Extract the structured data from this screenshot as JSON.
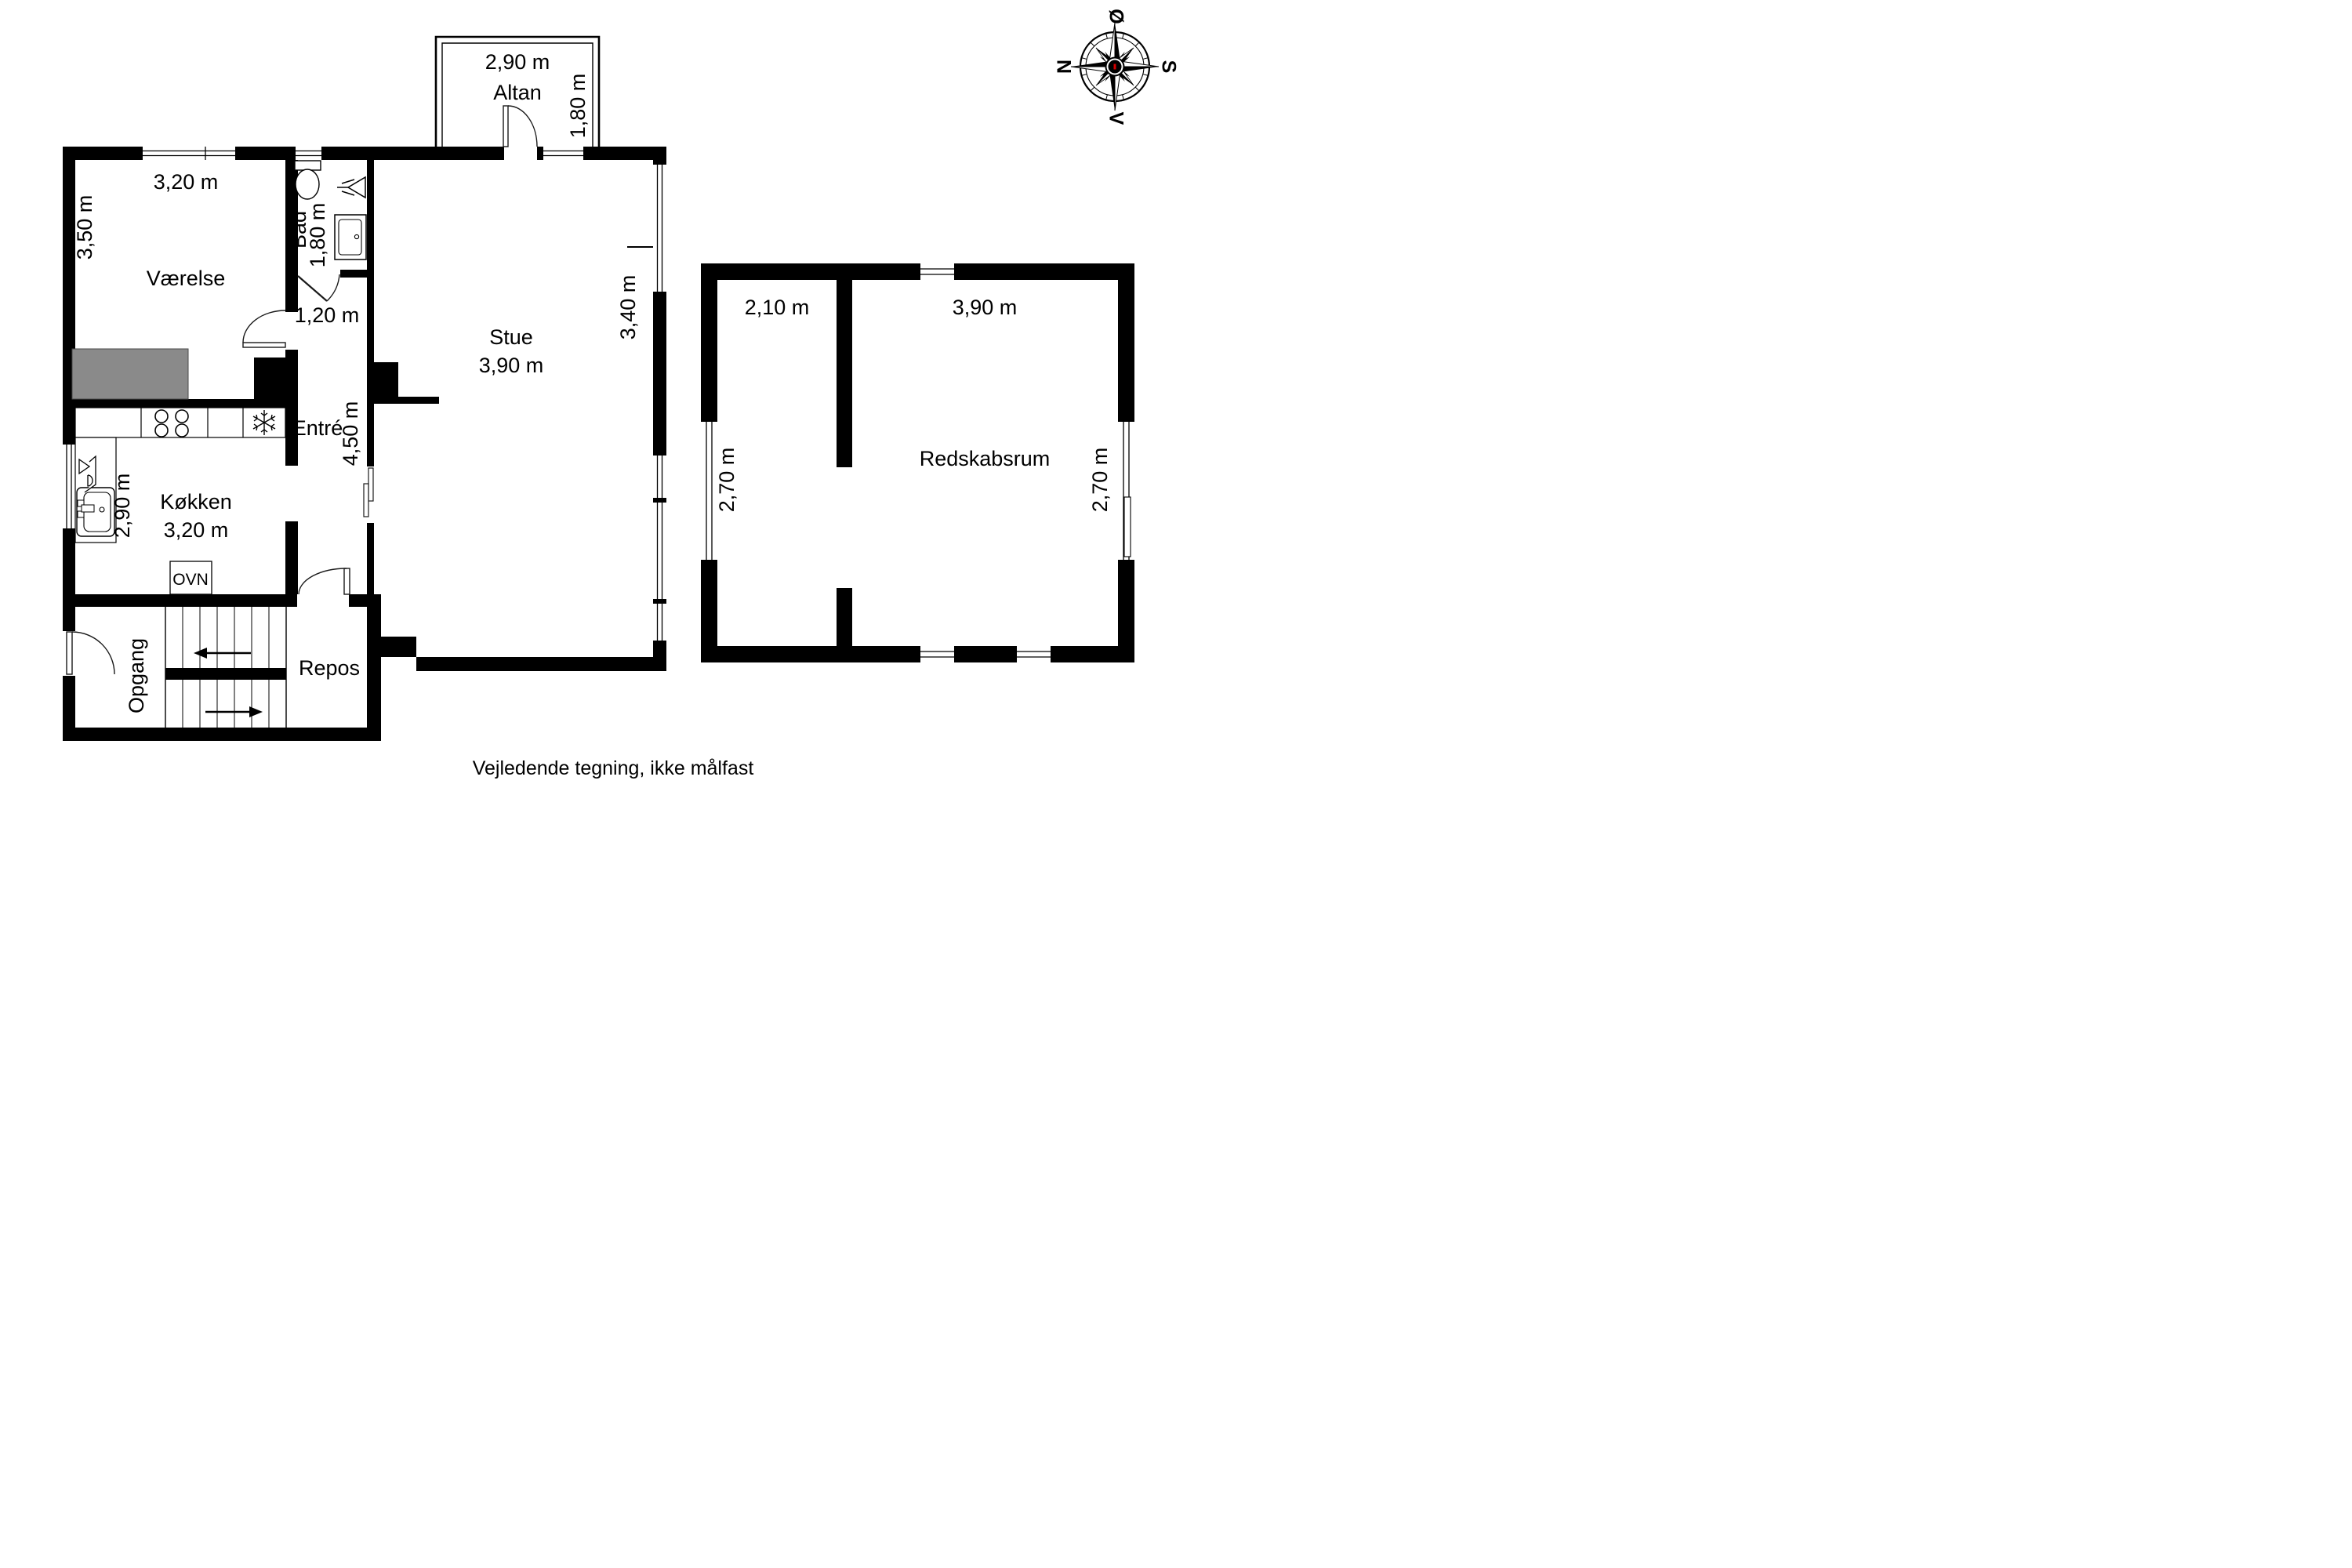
{
  "plan": {
    "altan": {
      "name": "Altan",
      "width": "2,90 m",
      "depth": "1,80 m"
    },
    "vaerelse": {
      "name": "Værelse",
      "width": "3,20 m",
      "height": "3,50 m"
    },
    "bad": {
      "name": "Bad",
      "depth": "1,80 m",
      "door": "1,20 m"
    },
    "stue": {
      "name": "Stue",
      "width": "3,90 m",
      "height": "3,40 m"
    },
    "entre": {
      "name": "Entré",
      "length": "4,50 m"
    },
    "kitchen": {
      "name": "Køkken",
      "width": "3,20 m",
      "height": "2,90 m",
      "oven": "OVN"
    },
    "opgang": {
      "name": "Opgang"
    },
    "repos": {
      "name": "Repos"
    },
    "outbuilding": {
      "name": "Redskabsrum",
      "left_width": "2,10 m",
      "left_height": "2,70 m",
      "right_width": "3,90 m",
      "right_height": "2,70 m"
    }
  },
  "compass": {
    "east": "Ø",
    "north": "N",
    "south": "S",
    "west": "V"
  },
  "footer": {
    "disclaimer": "Vejledende tegning, ikke målfast"
  },
  "colors": {
    "wall": "#000000",
    "furniture": "#8a8a8a",
    "accent_red": "#d40000",
    "background": "#ffffff"
  }
}
